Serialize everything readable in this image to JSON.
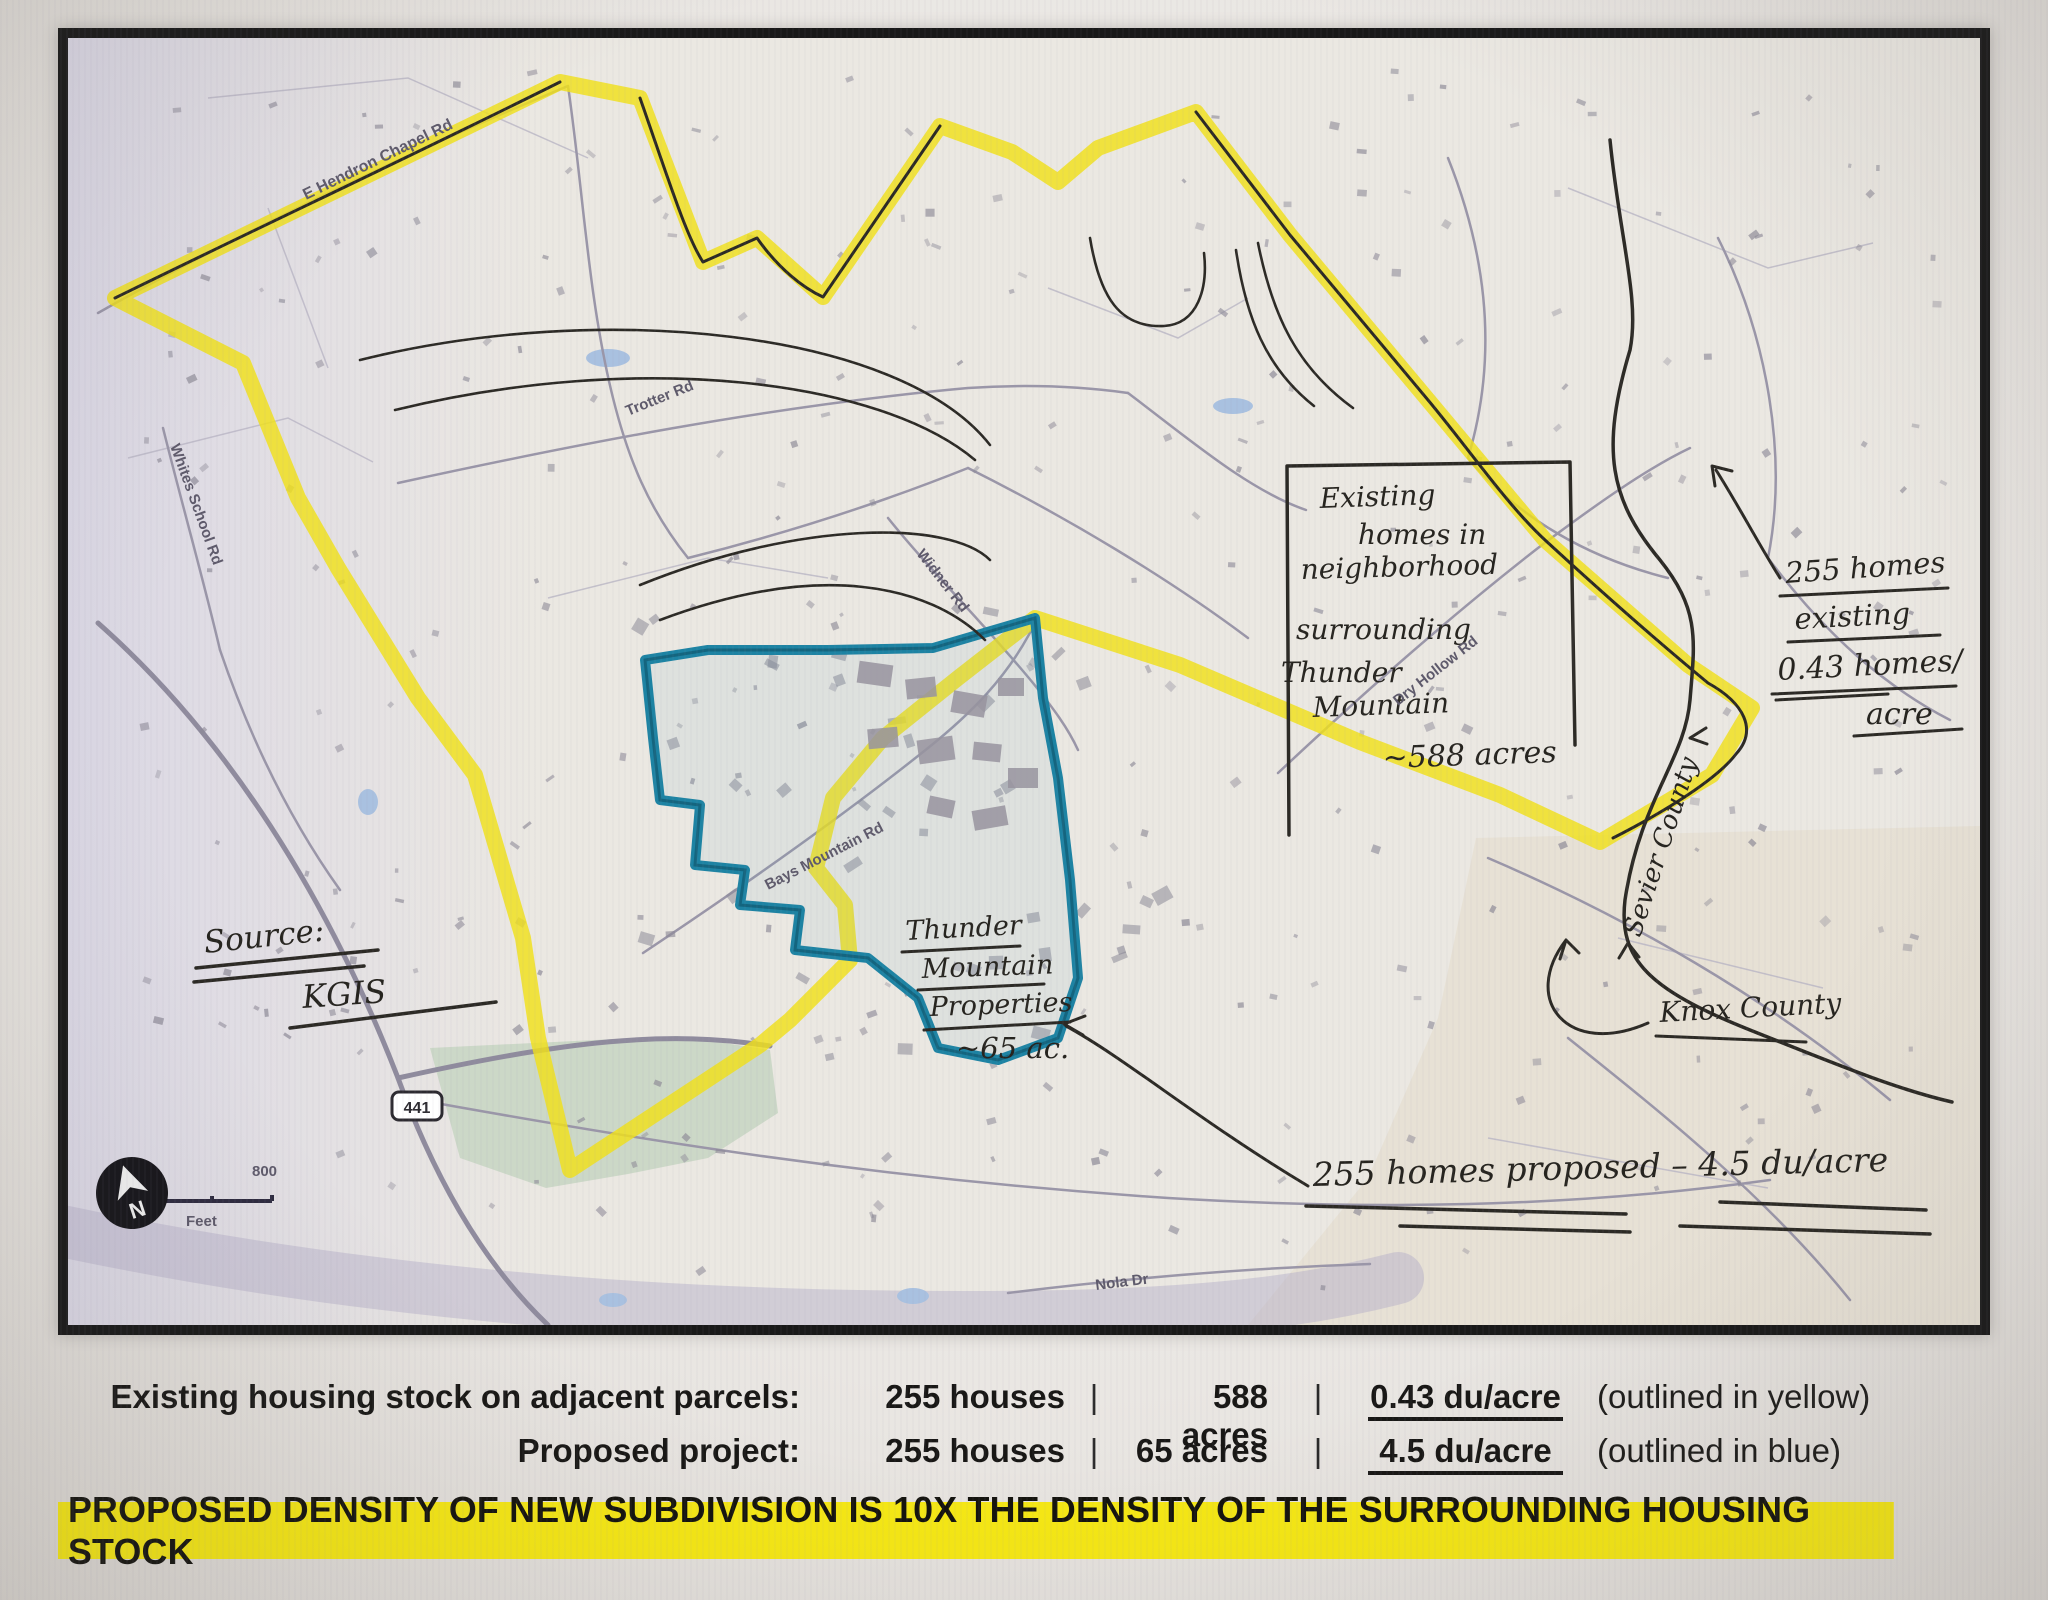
{
  "map": {
    "source_label": "Source:",
    "source_value": "KGIS",
    "note_box": {
      "l1": "Existing",
      "l2": "homes in",
      "l3": "neighborhood",
      "l4": "surrounding",
      "l5": "Thunder",
      "l6": "Mountain",
      "acreage": "~588 acres"
    },
    "existing_homes": {
      "l1": "255 homes",
      "l2": "existing",
      "l3": "0.43 homes/",
      "l4": "acre"
    },
    "parcel": {
      "l1": "Thunder",
      "l2": "Mountain",
      "l3": "Properties",
      "acreage": "~65 ac."
    },
    "proposed_annotation": "255 homes proposed – 4.5 du/acre",
    "counties": {
      "sevier": "Sevier County",
      "knox": "Knox County"
    },
    "roads": {
      "hendron_chapel": "E Hendron Chapel Rd",
      "trotter": "Trotter Rd",
      "widner": "Widner Rd",
      "bays_mountain": "Bays Mountain Rd",
      "dry_hollow": "Dry Hollow Rd",
      "whites_school": "Whites School Rd",
      "nola": "Nola Dr",
      "route_441": "441"
    },
    "scale_bar": {
      "start": "0",
      "end": "800",
      "unit": "Feet"
    },
    "north_label": "N"
  },
  "summary": {
    "rows": [
      {
        "label": "Existing housing stock on adjacent parcels:",
        "houses": "255 houses",
        "sep1": "|",
        "acres": "588 acres",
        "sep2": "|",
        "density": "0.43 du/acre",
        "note": "(outlined in yellow)"
      },
      {
        "label": "Proposed project:",
        "houses": "255 houses",
        "sep1": "|",
        "acres": "65 acres",
        "sep2": "|",
        "density": "4.5 du/acre",
        "note": "(outlined in blue)"
      }
    ],
    "banner": "PROPOSED DENSITY OF NEW SUBDIVISION IS 10X THE DENSITY OF THE SURROUNDING HOUSING STOCK"
  },
  "colors": {
    "highlight_yellow": "#f0e01a",
    "parcel_blue": "#1d83a3",
    "banner_yellow": "#f6e814",
    "ink": "#26241f"
  }
}
